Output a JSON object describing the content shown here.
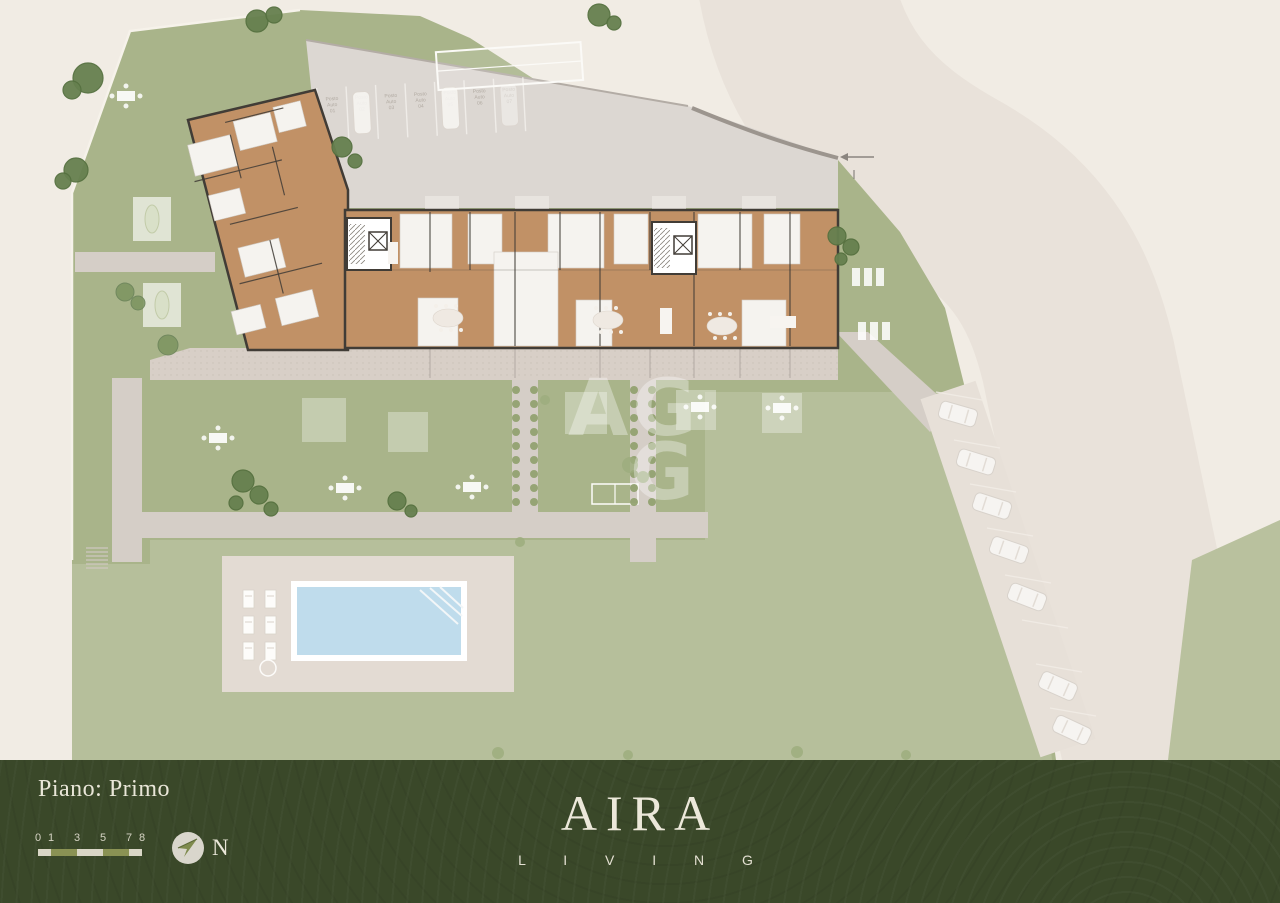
{
  "palette": {
    "bg": "#f1ece4",
    "lawn": "#a9b48a",
    "lawn_light": "#b9c19e",
    "road": "#e9e2da",
    "parking": "#dcd7d2",
    "path": "#d5cec7",
    "deck": "#e3dbd3",
    "terrace": "#d8cfc7",
    "wood": "#c19166",
    "wall": "#413c36",
    "room_white": "#f5f3ef",
    "pool_water": "#bfdcec",
    "tree_dark": "#66804f",
    "tree_mid": "#7e9562",
    "bush": "#9dad7e",
    "bar_bg": "#3a4829",
    "cream": "#eae6d8",
    "olive": "#8a9254",
    "scale_light": "#d9d6c6"
  },
  "plan": {
    "top_parking": {
      "word1": "Posto",
      "word2": "Auto",
      "numbers": [
        "01",
        "02",
        "03",
        "04",
        "05",
        "06",
        "07"
      ]
    },
    "watermark": {
      "line1": "AG",
      "line2": "G"
    }
  },
  "footer": {
    "floor_label": "Piano: Primo",
    "scalebar_ticks": [
      "0",
      "1",
      "3",
      "5",
      "7",
      "8"
    ],
    "compass_label": "N",
    "logo": {
      "title": "AIRA",
      "subtitle": "L I V I N G"
    }
  }
}
